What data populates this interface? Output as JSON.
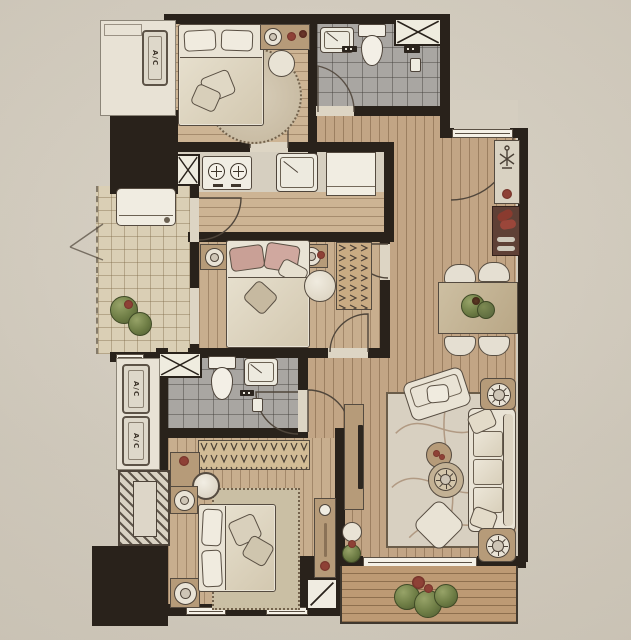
{
  "meta": {
    "type": "residential apartment floor plan",
    "rendering": "hand-colored architectural plan, photographed on cream paper"
  },
  "labels": {
    "ac_unit": "A/C"
  },
  "palette": {
    "photo_background": "#d6cfc1",
    "wall": "#29221b",
    "hall_wood_floor": "#c2a585",
    "bedroom_wood_floor": "#cdb494",
    "bathroom_tile": "#a9a6a2",
    "balcony_tile": "#dacfb5",
    "deck_wood": "#bd9a74",
    "linen_fabric": "#e9e3d5",
    "pink_pillow": "#c9a096",
    "furniture_wood": "#b69b79",
    "accent_red": "#8e4136",
    "plant_green": "#6e7d45"
  },
  "rooms": [
    "ac-balcony-top-left",
    "bedroom-1",
    "ensuite-bathroom",
    "kitchen",
    "utility-balcony",
    "bedroom-2",
    "hallway",
    "entry",
    "dining-area",
    "bathroom-2",
    "master-bedroom",
    "living-room",
    "rear-balcony",
    "ac-platform-left",
    "service-shaft"
  ],
  "fixtures": [
    "double-bed-with-pillows",
    "round-rug",
    "nightstand-lamp",
    "toilet",
    "washbasin",
    "walk-in-shower",
    "service-shaft-x-box",
    "two-burner-cooktop",
    "kitchen-sink",
    "refrigerator",
    "washing-machine",
    "wardrobe-with-hangers",
    "dining-table-for-four",
    "entry-shoe-cabinet",
    "coat-stand",
    "three-seat-sofa",
    "armchair",
    "tv-console",
    "round-coffee-tables",
    "ottoman",
    "floral-rug",
    "planter-boxes",
    "dressing-table-mirror",
    "door-swing-arcs",
    "window-bands",
    "ac-outdoor-units"
  ]
}
